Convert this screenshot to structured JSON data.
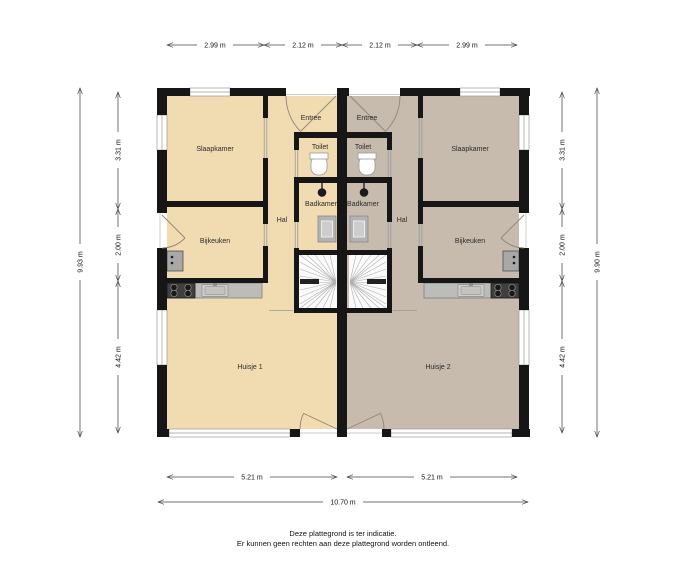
{
  "plan": {
    "unit1": {
      "living": "Huisje 1",
      "slaapkamer": "Slaapkamer",
      "bijkeuken": "Bijkeuken",
      "hal": "Hal",
      "badkamer": "Badkamer",
      "toilet": "Toilet",
      "entree": "Entree"
    },
    "unit2": {
      "living": "Huisje 2",
      "slaapkamer": "Slaapkamer",
      "bijkeuken": "Bijkeuken",
      "hal": "Hal",
      "badkamer": "Badkamer",
      "toilet": "Toilet",
      "entree": "Entree"
    },
    "colors": {
      "unit1_floor": "#f1dbb1",
      "unit2_floor": "#c6bbad",
      "wall": "#161616",
      "counter": "#bcbdb9"
    }
  },
  "dimensions": {
    "top": [
      "2.99 m",
      "2.12 m",
      "2.12 m",
      "2.99 m"
    ],
    "left_outer": "9.93 m",
    "left_inner": [
      "3.31 m",
      "2.00 m",
      "4.42 m"
    ],
    "right_inner": [
      "3.31 m",
      "2.00 m",
      "4.42 m"
    ],
    "right_outer": "9.90 m",
    "bottom": [
      "5.21 m",
      "5.21 m"
    ],
    "bottom_outer": "10.70 m"
  },
  "footer": {
    "line1": "Deze plattegrond is ter indicatie.",
    "line2": "Er kunnen geen rechten aan deze plattegrond worden ontleend."
  }
}
